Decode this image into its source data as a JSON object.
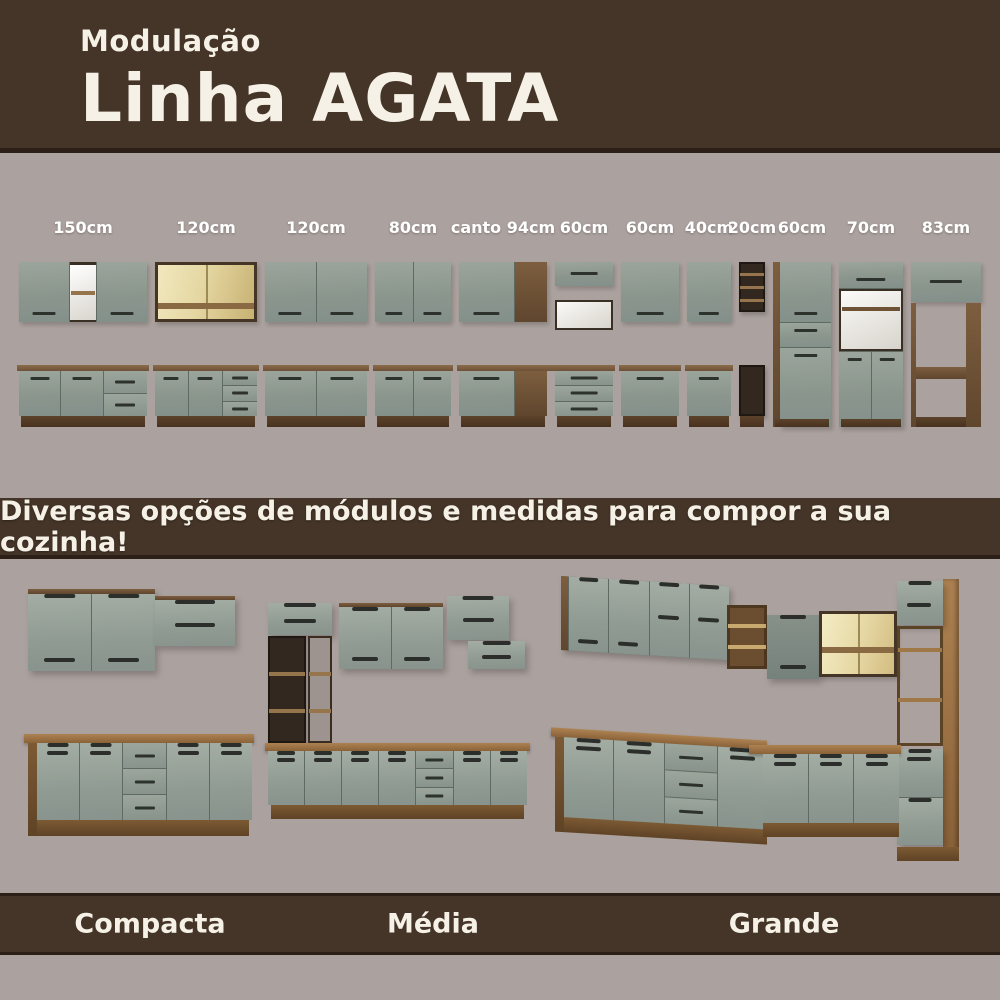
{
  "header": {
    "kicker": "Modulação",
    "title": "Linha AGATA"
  },
  "modules": {
    "labels": [
      "150cm",
      "120cm",
      "120cm",
      "80cm",
      "canto 94cm",
      "60cm",
      "60cm",
      "40cm",
      "20cm",
      "60cm",
      "70cm",
      "83cm"
    ]
  },
  "banner": {
    "text": "Diversas opções de módulos e medidas para compor a sua cozinha!"
  },
  "footer": {
    "labels": [
      "Compacta",
      "Média",
      "Grande"
    ]
  },
  "colors": {
    "band_brown": "#453528",
    "band_edge": "#2b1f17",
    "background_gray": "#aba19e",
    "cabinet_sage": "#8e998f",
    "wood_dark": "#6b4e33",
    "wood_oak": "#a07848",
    "glass_amber": "#e5d7a2",
    "text_cream": "#f6f1e6",
    "handle_dark": "#2d322d"
  }
}
